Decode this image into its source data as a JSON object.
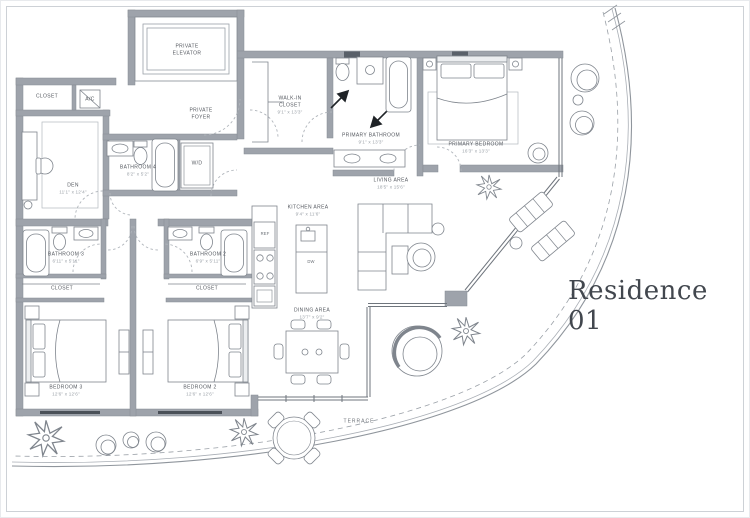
{
  "title": "Residence 01",
  "colors": {
    "wall": "#9ea3ab",
    "wall_stroke": "#868c94",
    "line": "#7f858d",
    "window_dark": "#4a5058",
    "label_text": "#54585f",
    "dims_text": "#9aa0a7",
    "title_text": "#42474e"
  },
  "rooms": [
    {
      "id": "private-elevator",
      "name": "PRIVATE ELEVATOR",
      "dims": ""
    },
    {
      "id": "private-foyer",
      "name": "PRIVATE FOYER",
      "dims": ""
    },
    {
      "id": "closet-den",
      "name": "CLOSET",
      "dims": ""
    },
    {
      "id": "ac",
      "name": "A/C",
      "dims": ""
    },
    {
      "id": "den",
      "name": "DEN",
      "dims": "11'1\" x 12'4\""
    },
    {
      "id": "bathroom-4",
      "name": "BATHROOM 4",
      "dims": "8'2\" x 5'2\""
    },
    {
      "id": "wd",
      "name": "W/D",
      "dims": ""
    },
    {
      "id": "walk-in-closet",
      "name": "WALK-IN CLOSET",
      "dims": "9'1\" x 13'3\""
    },
    {
      "id": "primary-bathroom",
      "name": "PRIMARY BATHROOM",
      "dims": "9'1\" x 13'3\""
    },
    {
      "id": "primary-bedroom",
      "name": "PRIMARY BEDROOM",
      "dims": "16'3\" x 13'3\""
    },
    {
      "id": "living-area",
      "name": "LIVING AREA",
      "dims": "18'5\" x 15'6\""
    },
    {
      "id": "kitchen-area",
      "name": "KITCHEN AREA",
      "dims": "9'4\" x 11'6\""
    },
    {
      "id": "dining-area",
      "name": "DINING AREA",
      "dims": "13'7\" x 9'2\""
    },
    {
      "id": "bathroom-3",
      "name": "BATHROOM 3",
      "dims": "6'11\" x 5'11\""
    },
    {
      "id": "bathroom-2",
      "name": "BATHROOM 2",
      "dims": "6'9\" x 5'11\""
    },
    {
      "id": "closet-3",
      "name": "CLOSET",
      "dims": ""
    },
    {
      "id": "closet-2",
      "name": "CLOSET",
      "dims": ""
    },
    {
      "id": "bedroom-3",
      "name": "BEDROOM 3",
      "dims": "12'6\" x 12'6\""
    },
    {
      "id": "bedroom-2",
      "name": "BEDROOM 2",
      "dims": "12'6\" x 12'6\""
    },
    {
      "id": "terrace",
      "name": "TERRACE",
      "dims": ""
    },
    {
      "id": "ref",
      "name": "REF",
      "dims": ""
    },
    {
      "id": "dw",
      "name": "DW",
      "dims": ""
    }
  ]
}
